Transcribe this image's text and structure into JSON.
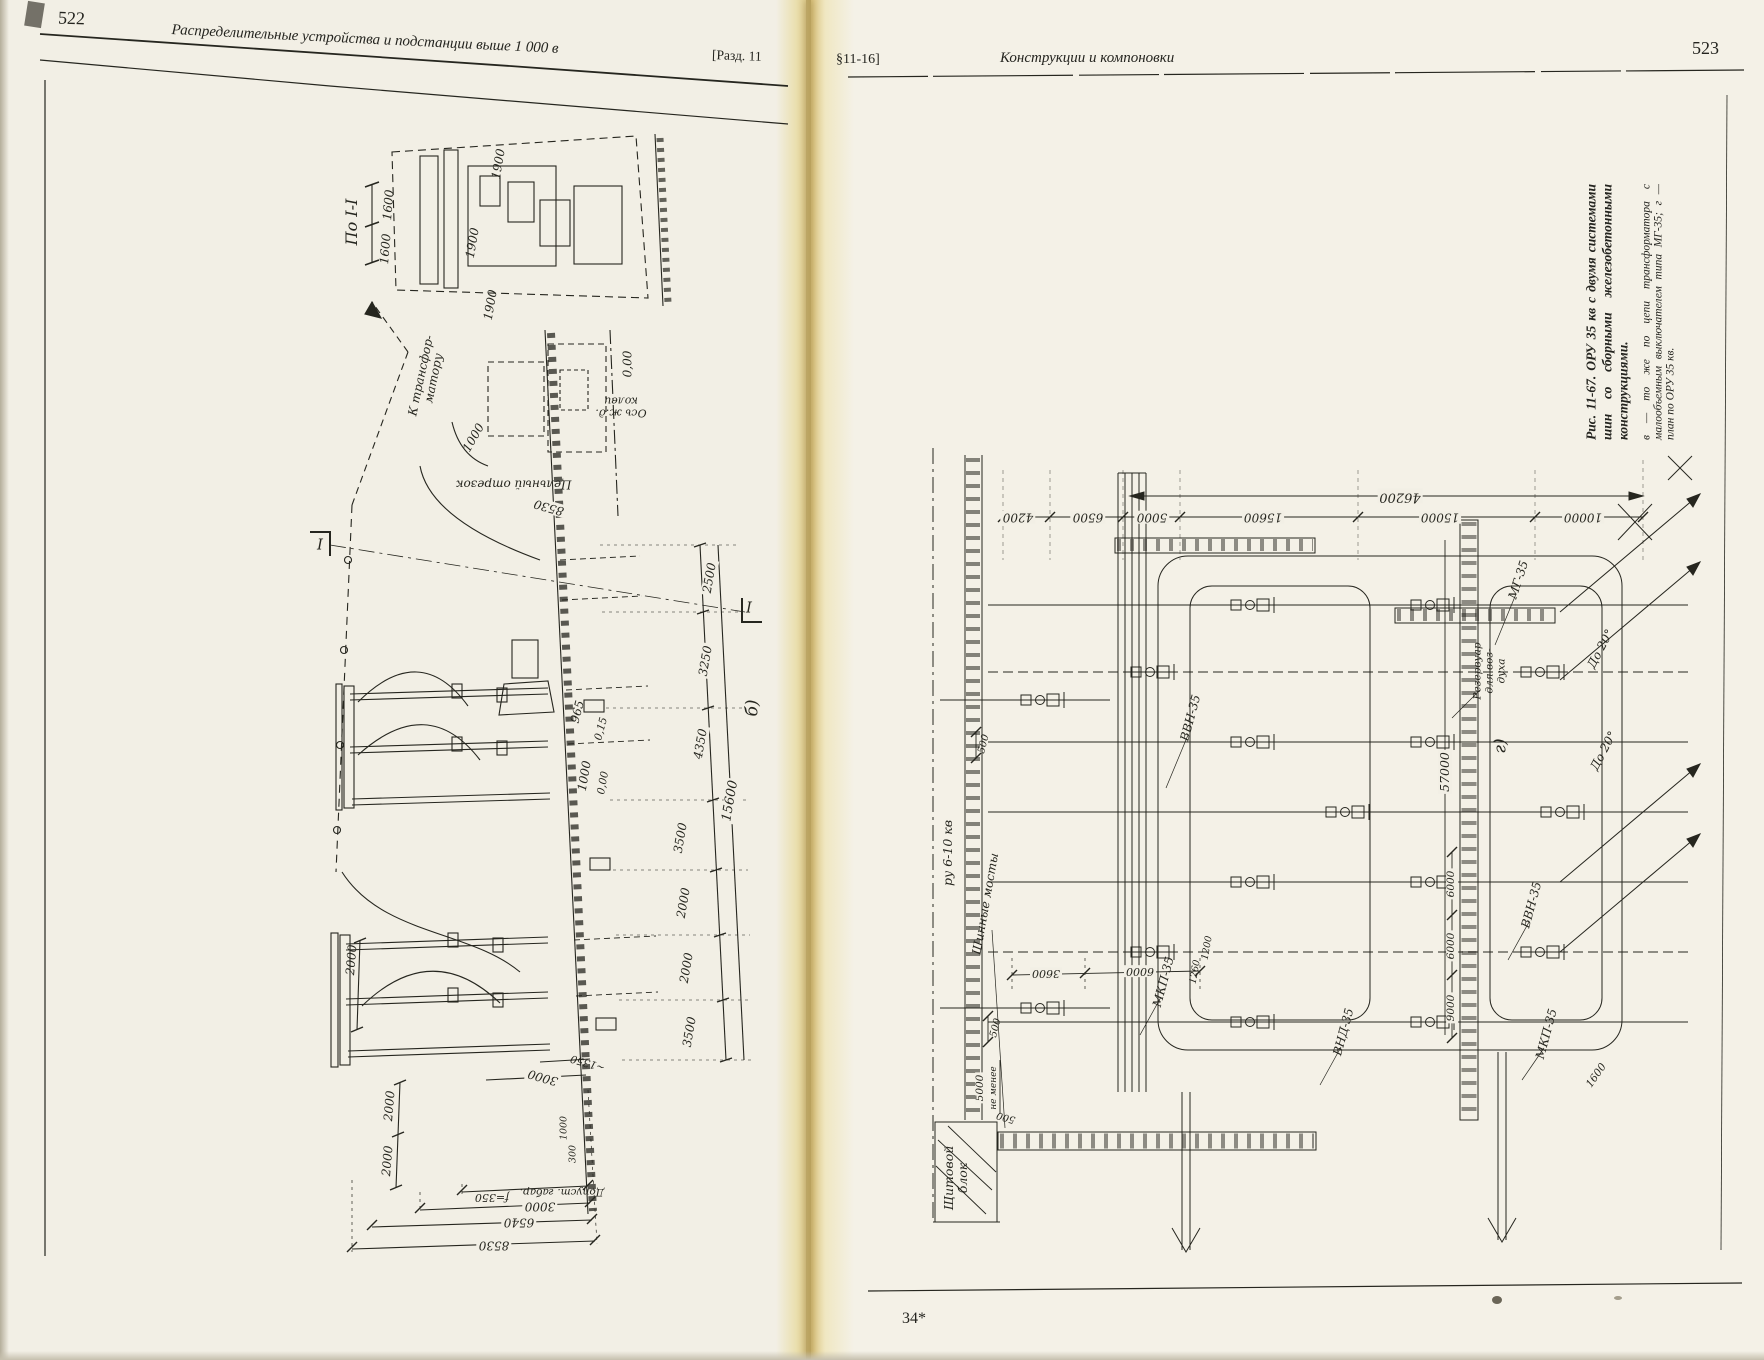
{
  "lp": {
    "num": "522",
    "title": "Распределительные устройства и подстанции выше 1 000 в",
    "sec": "[Разд. 11",
    "fig": {
      "view": "По I-I",
      "part": "б)",
      "mark": "I",
      "d1600a": "1600",
      "d1600b": "1600",
      "d1900a": "1900",
      "d1900b": "1900",
      "d1900c": "1900",
      "to_tr": "К трансфор-\nматору",
      "r1000": "1000",
      "lvl0top": "0,00",
      "axis": "Ось ж.д.\nколеи",
      "solid": "Цельный отрезок",
      "d8530t": "8530",
      "d2500": "2500",
      "d3250": "3250",
      "d4350": "4350",
      "t15600": "15600",
      "d965": "965",
      "d015": "0,15",
      "d1000": "1000",
      "lvl0": "0,00",
      "c3500a": "3500",
      "c2000a": "2000",
      "c2000b": "2000",
      "c3500b": "3500",
      "l2000a": "2000",
      "l2000b": "2000",
      "l2000c": "2000",
      "d3000m": "3000",
      "d1350": "~1350",
      "s1000": "1000",
      "s300": "300",
      "bf350": "f=350",
      "b3000": "3000",
      "b6540": "6540",
      "b8530": "8530",
      "clr": "Допуст. габар."
    }
  },
  "rp": {
    "sec": "§11-16]",
    "title": "Конструкции и компоновки",
    "num": "523",
    "cap1": "Рис. 11-67. ОРУ 35 кв с двумя системами шин со сборными железобетонными конструкциями.",
    "cap2": "в — то же по цепи трансформатора с малообъемным выключателем типа МГ-35; г — план по ОРУ 35 кв.",
    "sig": "34*",
    "fig": {
      "part": "г)",
      "d4200": "4200",
      "d6500": "6500",
      "d5000": "5000",
      "d15600": "15600",
      "d15000": "15000",
      "d10000": "10000",
      "t46200": "46200",
      "t57000": "57000",
      "ru": "ру 6-10 кв",
      "bridges": "Шинные мосты",
      "panel": "Щитовой\nблок",
      "tank": "Резервуар\nдля воз-\nдуха",
      "mg": "МГ-35",
      "vvn1": "ВВН-35",
      "vvn2": "ВВН-35",
      "mkp1": "МКП-35",
      "mkp2": "МКП-35",
      "vnd": "ВНД-35",
      "do20a": "До 20°",
      "do20b": "До 20°",
      "s500a": "500",
      "s500b": "500",
      "s500c": "500",
      "s5000": "5000",
      "nmen": "не менее",
      "d3600": "3600",
      "d6000t": "6000",
      "d1260": "1260",
      "d1200": "1200",
      "r6000a": "6000",
      "r6000b": "6000",
      "r9000": "9000",
      "r1600": "1600"
    }
  }
}
